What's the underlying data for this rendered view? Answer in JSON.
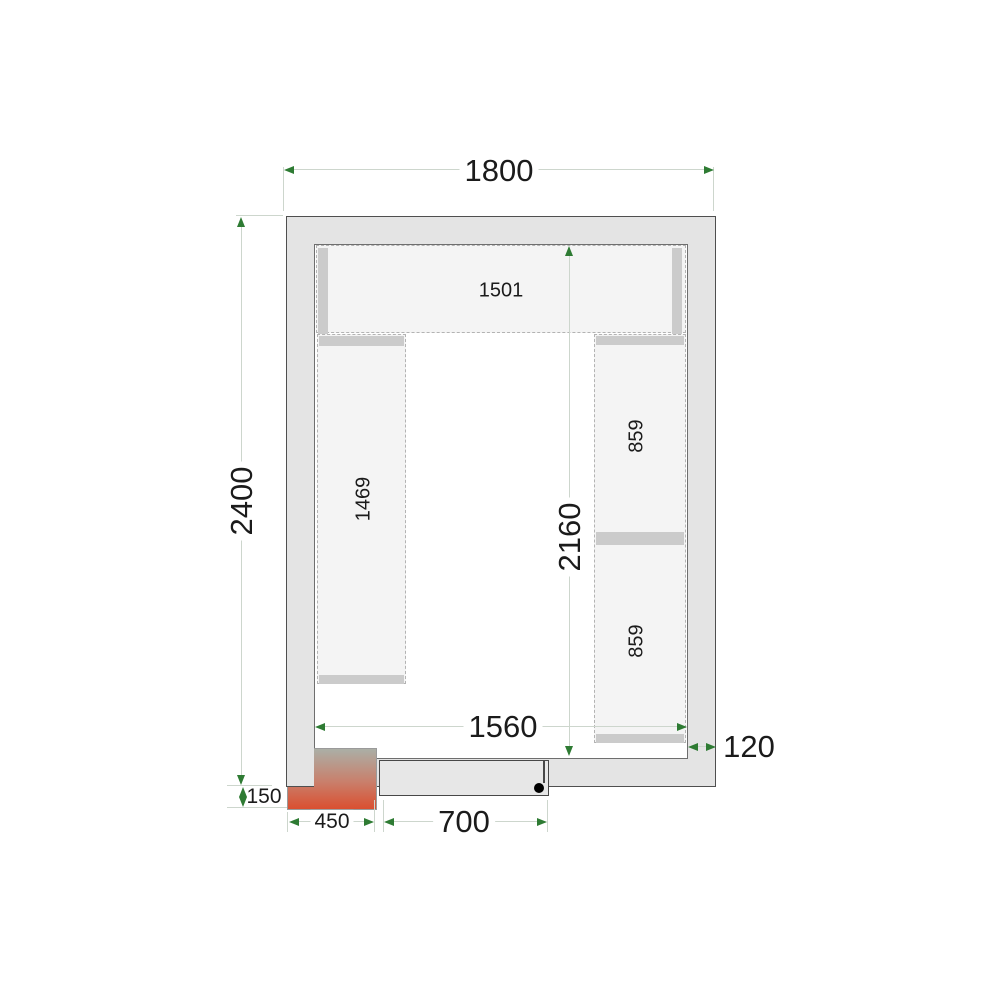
{
  "diagram_title": "cold-room-floor-plan",
  "dims": {
    "outer_width": "1800",
    "outer_depth": "2400",
    "inner_width": "1560",
    "inner_depth": "2160",
    "wall_thickness": "120",
    "door_width": "700",
    "unit_width": "450",
    "unit_offset": "150"
  },
  "shelves": {
    "top": "1501",
    "left": "1469",
    "right_upper": "859",
    "right_lower": "859"
  },
  "colors": {
    "wall_fill": "#e4e4e4",
    "wall_border": "#4f4f4f",
    "floor_border": "#6e6e6e",
    "shelf_fill": "#f4f4f4",
    "shelf_border": "#b3b3b3",
    "shelf_bar": "#cbcbcb",
    "dim_line": "#cdd6cd",
    "arrow": "#2e7b33",
    "text": "#1b1b1b",
    "unit_top": "#abafa6",
    "unit_bottom": "#da4f30"
  }
}
